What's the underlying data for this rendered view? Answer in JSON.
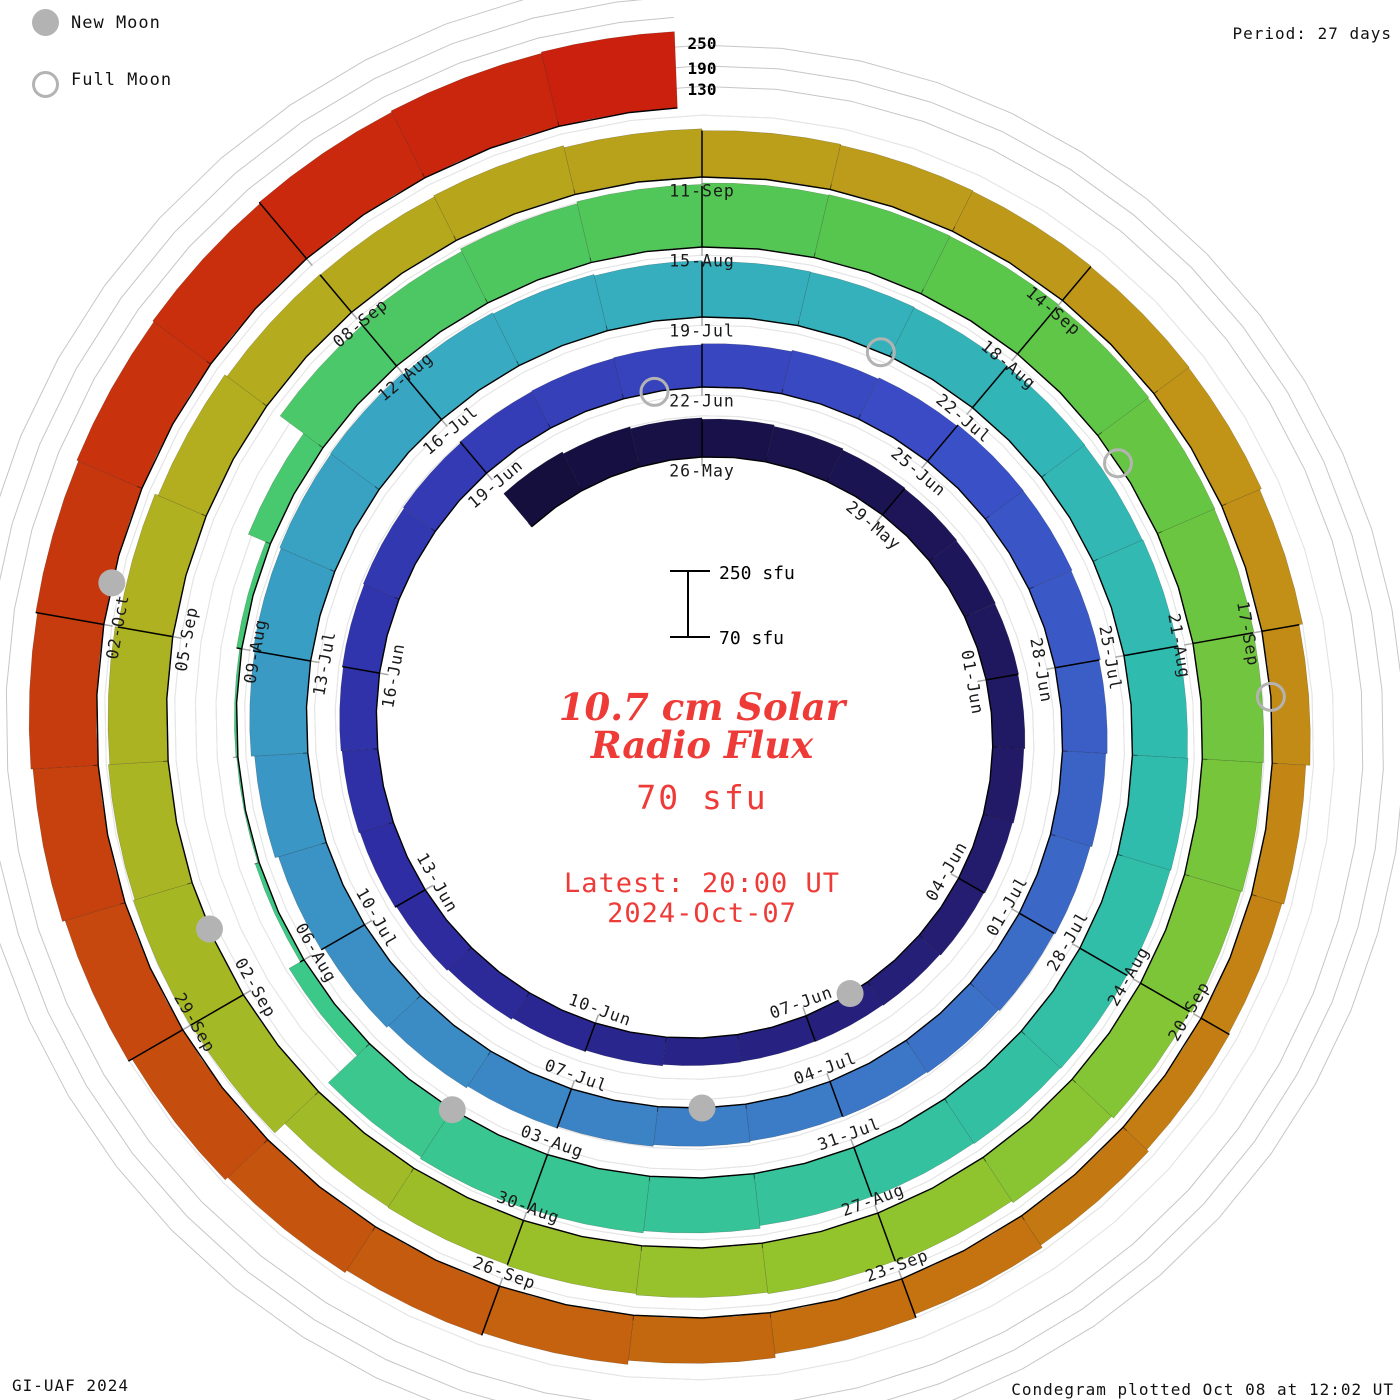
{
  "legend": {
    "new_moon_label": "New Moon",
    "full_moon_label": "Full Moon",
    "marker_color": "#b3b3b3"
  },
  "header": {
    "period_label": "Period: 27 days"
  },
  "footer": {
    "credit": "GI-UAF 2024",
    "plotted": "Condegram plotted Oct 08 at 12:02 UT"
  },
  "center": {
    "title_line1": "10.7 cm Solar",
    "title_line2": "Radio Flux",
    "baseline_value": "70 sfu",
    "latest_line1": "Latest: 20:00 UT",
    "latest_line2": "2024-Oct-07",
    "text_color": "#ee3b38"
  },
  "scale_bar": {
    "top_label": "250 sfu",
    "bottom_label": "70 sfu"
  },
  "radial_axis_labels": [
    "250",
    "190",
    "130"
  ],
  "chart_data": {
    "type": "bar",
    "subtype": "spiral-condegram",
    "title": "10.7 cm Solar Radio Flux",
    "units": "sfu",
    "period_days": 27,
    "baseline_sfu": 70,
    "gridlines_sfu": [
      130,
      190,
      250
    ],
    "start_date": "2024-05-23",
    "angle_zero_date": "2024-05-26",
    "end_date": "2024-10-07",
    "last_day_fraction": 0.83,
    "date_labels": [
      "26-May",
      "29-May",
      "01-Jun",
      "04-Jun",
      "07-Jun",
      "10-Jun",
      "13-Jun",
      "16-Jun",
      "19-Jun",
      "22-Jun",
      "25-Jun",
      "28-Jun",
      "01-Jul",
      "04-Jul",
      "07-Jul",
      "10-Jul",
      "13-Jul",
      "16-Jul",
      "19-Jul",
      "22-Jul",
      "25-Jul",
      "28-Jul",
      "31-Jul",
      "03-Aug",
      "06-Aug",
      "09-Aug",
      "12-Aug",
      "15-Aug",
      "18-Aug",
      "21-Aug",
      "24-Aug",
      "27-Aug",
      "30-Aug",
      "02-Sep",
      "05-Sep",
      "08-Sep",
      "11-Sep",
      "14-Sep",
      "17-Sep",
      "20-Sep",
      "23-Sep",
      "26-Sep",
      "29-Sep",
      "02-Oct"
    ],
    "flux_daily": [
      196,
      190,
      184,
      180,
      176,
      172,
      170,
      168,
      166,
      164,
      161,
      158,
      155,
      152,
      150,
      149,
      150,
      154,
      158,
      163,
      167,
      171,
      174,
      177,
      180,
      183,
      186,
      189,
      191,
      193,
      196,
      200,
      204,
      208,
      207,
      204,
      200,
      196,
      191,
      187,
      183,
      180,
      178,
      181,
      186,
      192,
      198,
      205,
      215,
      225,
      235,
      240,
      244,
      246,
      242,
      238,
      234,
      231,
      230,
      228,
      227,
      226,
      228,
      230,
      232,
      230,
      228,
      226,
      224,
      222,
      230,
      236,
      240,
      235,
      120,
      82,
      74,
      76,
      85,
      140,
      225,
      238,
      246,
      252,
      256,
      258,
      257,
      255,
      252,
      250,
      248,
      245,
      241,
      235,
      228,
      222,
      218,
      214,
      210,
      207,
      205,
      245,
      248,
      244,
      240,
      232,
      222,
      214,
      212,
      216,
      210,
      205,
      202,
      200,
      198,
      196,
      190,
      180,
      168,
      162,
      165,
      172,
      180,
      190,
      202,
      214,
      222,
      230,
      240,
      252,
      260,
      266,
      271,
      276,
      280,
      284,
      288,
      292
    ],
    "moon_markers": {
      "new_moon_day_offsets": [
        11.3,
        40.5,
        70.0,
        99.6,
        129.3
      ],
      "full_moon_day_offsets": [
        26.4,
        55.9,
        85.3,
        114.5
      ]
    },
    "palette_stops": [
      [
        0.0,
        "#150f3e"
      ],
      [
        0.075,
        "#221a68"
      ],
      [
        0.155,
        "#2e2da4"
      ],
      [
        0.235,
        "#3a4cc6"
      ],
      [
        0.315,
        "#3c80c6"
      ],
      [
        0.395,
        "#38aac2"
      ],
      [
        0.465,
        "#2fbcae"
      ],
      [
        0.545,
        "#3dc987"
      ],
      [
        0.625,
        "#58c64b"
      ],
      [
        0.7,
        "#94c42c"
      ],
      [
        0.775,
        "#b3ae1f"
      ],
      [
        0.845,
        "#c29116"
      ],
      [
        0.9,
        "#c46d0f"
      ],
      [
        0.95,
        "#c6400e"
      ],
      [
        1.0,
        "#cb200d"
      ]
    ]
  }
}
